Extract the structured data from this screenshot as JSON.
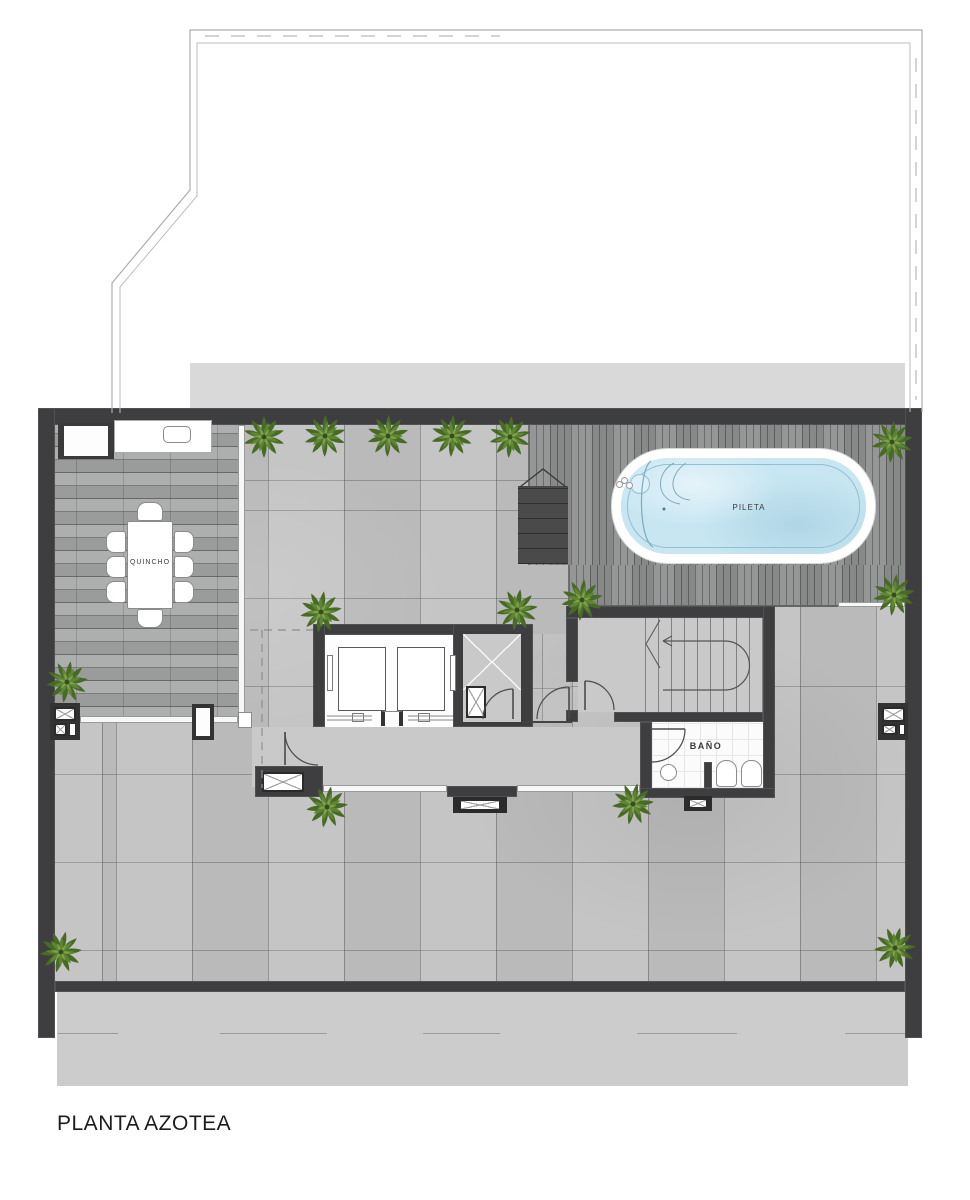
{
  "plan": {
    "title": "PLANTA AZOTEA",
    "labels": {
      "quincho": "QUINCHO",
      "pool": "PILETA",
      "bathroom": "BAÑO"
    },
    "colors": {
      "wall": "#3e3e40",
      "tile_floor": "#c2c2c2",
      "quincho_wood": "#a6a7a7",
      "pool_deck_wood": "#8f9091",
      "pool_water": "#c7e6f2",
      "hall_floor": "#c9c9c9",
      "slab_band": "#d9d9d9",
      "apron": "#cccccc",
      "plant_green": "#4c6b28"
    }
  }
}
